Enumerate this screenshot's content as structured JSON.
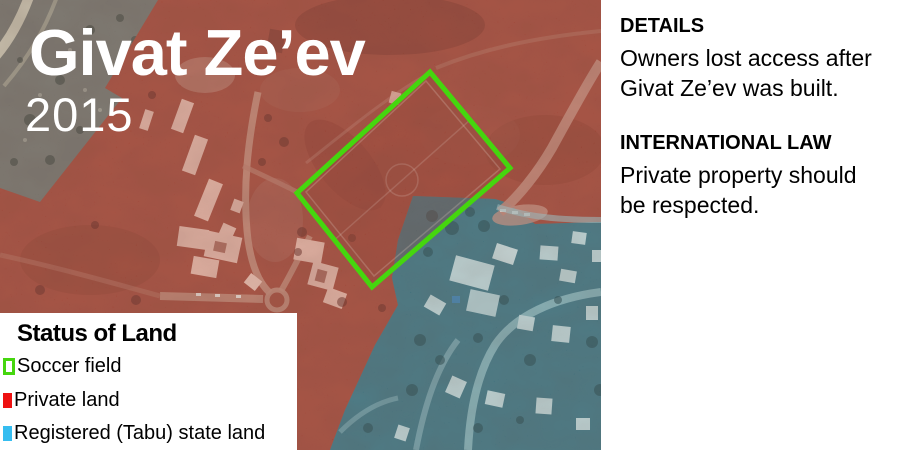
{
  "map": {
    "title": "Givat Ze’ev",
    "year": "2015",
    "colors": {
      "soccer_field_outline": "#45d60e",
      "private_land_overlay": "#a73c2a",
      "state_land_overlay": "#2f7080"
    }
  },
  "legend": {
    "title": "Status of Land",
    "items": [
      {
        "label": "Soccer field",
        "swatch": "green-outline",
        "color": "#45d60e"
      },
      {
        "label": "Private land",
        "swatch": "solid",
        "color": "#ee1111"
      },
      {
        "label": "Registered (Tabu) state land",
        "swatch": "solid",
        "color": "#35bdf0"
      }
    ]
  },
  "side_panel": {
    "details_heading": "DETAILS",
    "details_body": "Owners lost access after\nGivat Ze’ev was built.",
    "law_heading": "INTERNATIONAL LAW",
    "law_body": "Private property should\nbe respected."
  }
}
